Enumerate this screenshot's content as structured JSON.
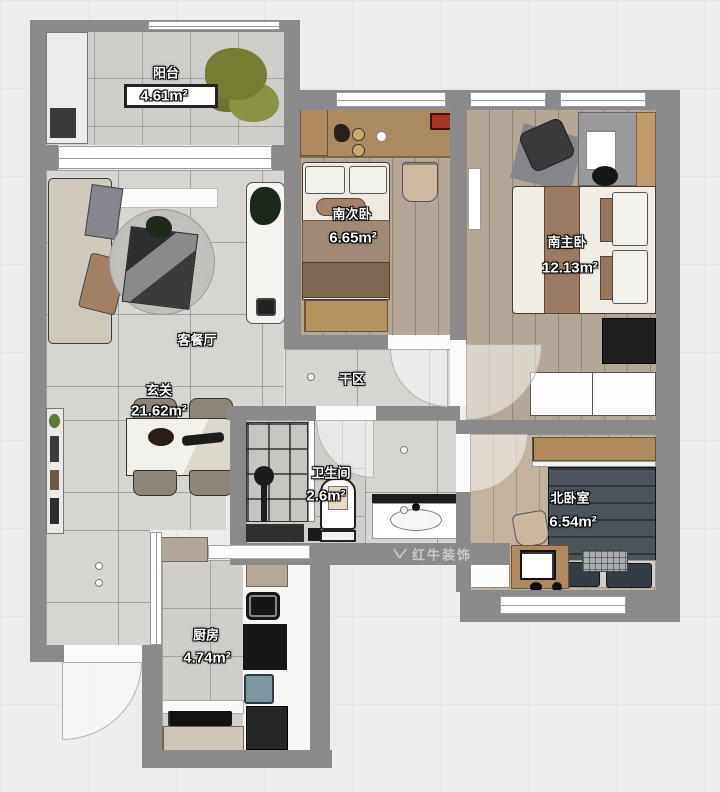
{
  "plan": {
    "watermark": "红牛装饰",
    "rooms": [
      {
        "key": "balcony",
        "name": "阳台",
        "area": "4.61m²"
      },
      {
        "key": "living-dining",
        "name": "客餐厅"
      },
      {
        "key": "foyer",
        "name": "玄关",
        "area": "21.62m²"
      },
      {
        "key": "south-second-bedroom",
        "name": "南次卧",
        "area": "6.65m²"
      },
      {
        "key": "south-master-bedroom",
        "name": "南主卧",
        "area": "12.13m²"
      },
      {
        "key": "dry-area",
        "name": "干区"
      },
      {
        "key": "bathroom",
        "name": "卫生间",
        "area": "2.6m²"
      },
      {
        "key": "north-bedroom",
        "name": "北卧室",
        "area": "6.54m²"
      },
      {
        "key": "kitchen",
        "name": "厨房",
        "area": "4.74m²"
      }
    ],
    "colors": {
      "wall": "#8a8a8a",
      "tile": "#d6d5d2",
      "wood_floor": "#b4a797",
      "accent_wood": "#b08a5f"
    }
  }
}
